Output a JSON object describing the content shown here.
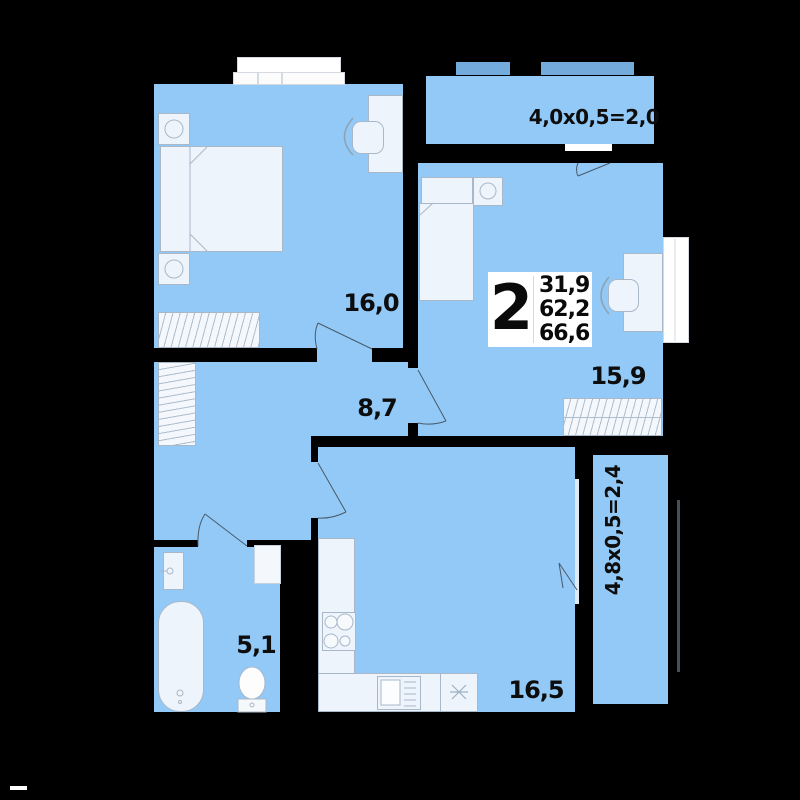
{
  "colors": {
    "background": "#000000",
    "floor": "#92c9f7",
    "floor-dark": "#74abdd",
    "furniture": "#eef4fb",
    "stroke": "#a9b8c8",
    "line": "#4a5a68",
    "label": "#0d0d0d",
    "white": "#ffffff"
  },
  "badge": {
    "rooms": "2",
    "area_living": "31,9",
    "area_apartment": "62,2",
    "area_total": "66,6"
  },
  "rooms": {
    "bedroom": "16,0",
    "hall": "8,7",
    "living": "15,9",
    "bathroom": "5,1",
    "kitchen": "16,5"
  },
  "balconies": {
    "top": "4,0x0,5=2,0",
    "right": "4,8x0,5=2,4"
  }
}
